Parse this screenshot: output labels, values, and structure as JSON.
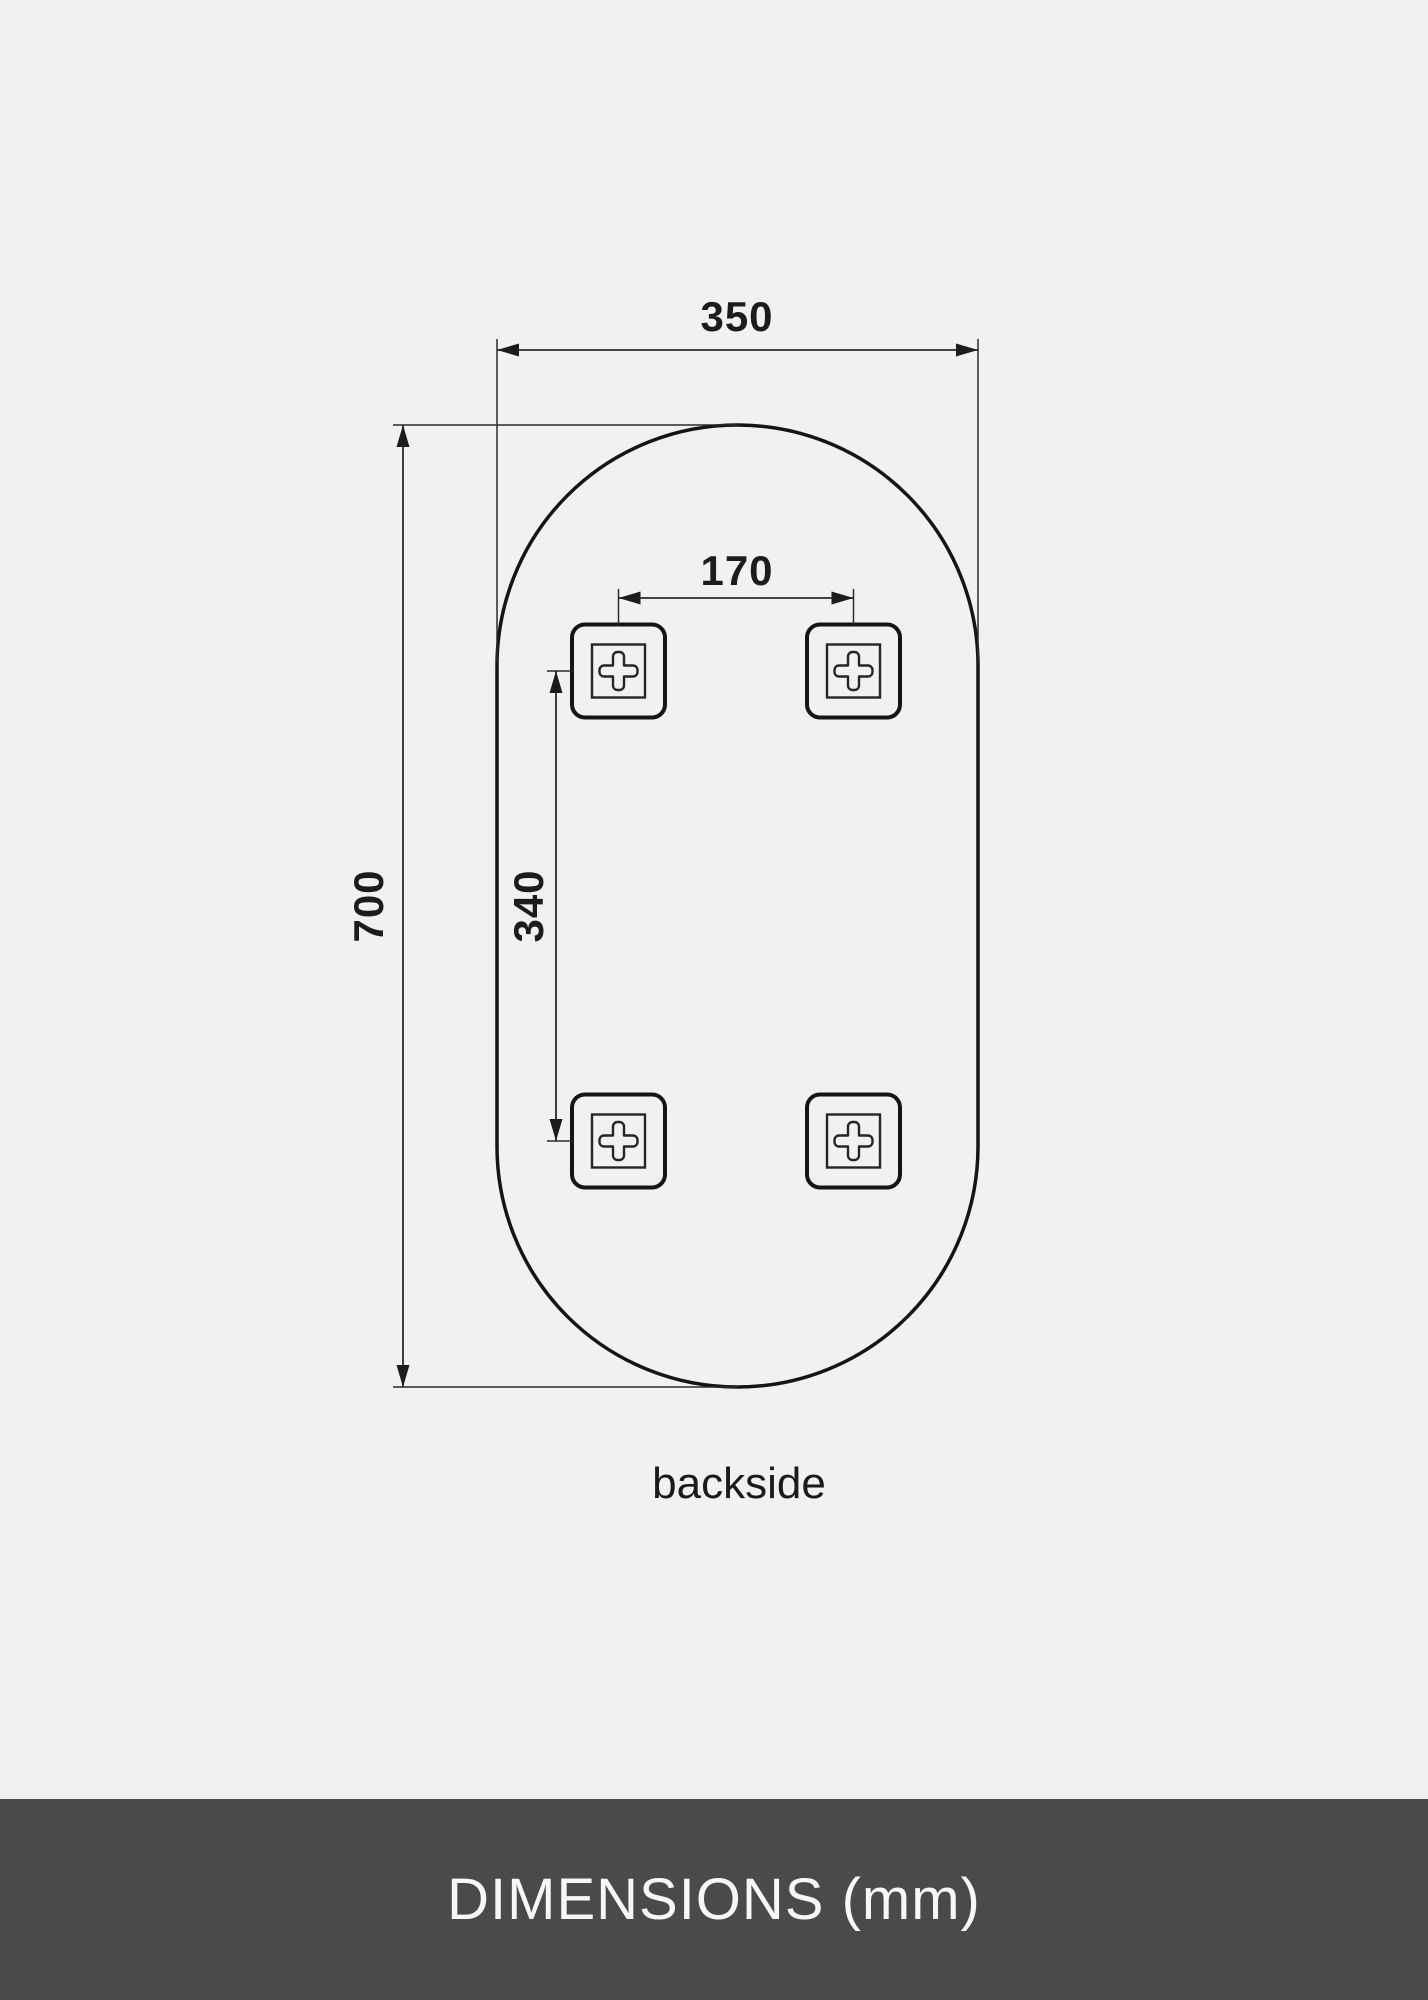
{
  "page": {
    "background_color": "#f1f1f2",
    "line_color": "#1c1c1c"
  },
  "diagram": {
    "type": "technical-dimension-drawing",
    "subject": "pill-shaped mirror, rear view with mounting brackets",
    "overall_width_mm": "350",
    "overall_height_mm": "700",
    "bracket_spacing_horizontal_mm": "170",
    "bracket_spacing_vertical_mm": "340",
    "caption": "backside",
    "bracket_count": 4
  },
  "footer": {
    "title": "DIMENSIONS (mm)",
    "background_color": "#4a4a4b",
    "text_color": "#f7f7f7"
  }
}
